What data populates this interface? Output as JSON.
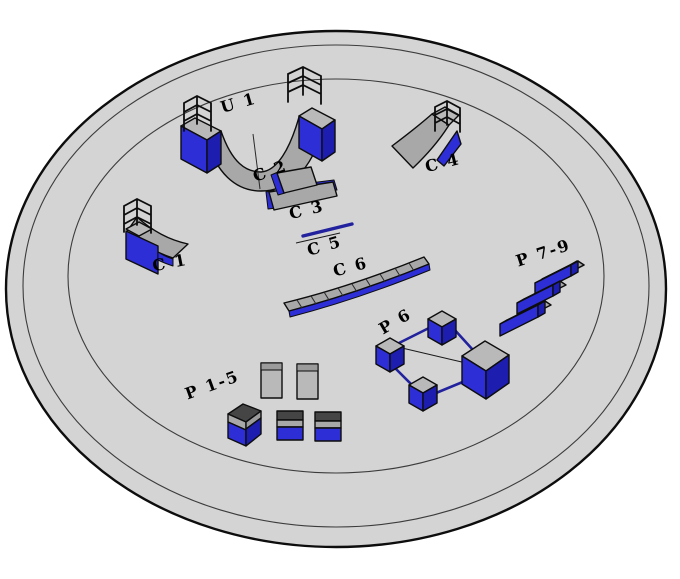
{
  "park": {
    "labels": {
      "u1": "U 1",
      "c1": "C 1",
      "c2": "C 2",
      "c3": "C 3",
      "c4": "C 4",
      "c5": "C 5",
      "c6": "C 6",
      "p1_5": "P 1-5",
      "p6": "P 6",
      "p7_9": "P 7-9"
    },
    "colors": {
      "floor": "#d4d4d4",
      "obstacle_blue": "#2e2ed6",
      "obstacle_blue_dark": "#1d1db0",
      "ramp_gray": "#a8a8a8",
      "deck_gray": "#b9b9b9",
      "dark_top": "#454545",
      "mid_gray": "#9b9b9b",
      "outline": "#0d0d0d",
      "ring_line": "#3c3c3c",
      "rail_blue": "#22229e",
      "background": "#ffffff",
      "label_color": "#000000"
    }
  }
}
